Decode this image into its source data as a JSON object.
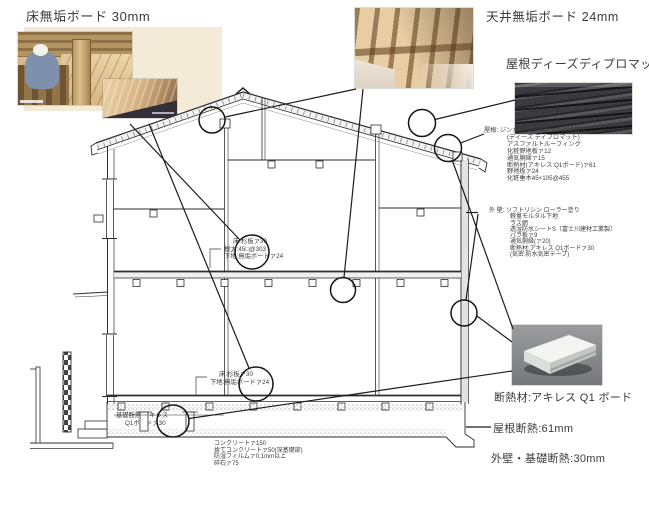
{
  "labels": {
    "floor_board": "床無垢ボード 30mm",
    "ceiling_board": "天井無垢ボード 24mm",
    "roof_diplomat": "屋根ディーズディプロマット",
    "insulation_board": "断熱材:アキレス Q1 ボード",
    "roof_insulation": "屋根断熱:61mm",
    "wall_foundation_insulation": "外壁・基礎断熱:30mm"
  },
  "roof_spec": {
    "heading": "屋根:",
    "lines": [
      "ジンカリウム鋼板ァ0.39横葺き",
      "(ディーズ ディプロマット)",
      "アスファルトルーフィング",
      "化粧野地板ァ12",
      "通気胴縁ァ15",
      "断熱材(アキレス:Q1ボード)ァ61",
      "野地板ァ24",
      "化粧垂木45×105@455"
    ]
  },
  "wall_spec": {
    "heading": "外 壁:",
    "lines": [
      "ソフトリシン ローラー塗り",
      "軽量モルタル下地",
      "ラス網",
      "透湿防水シートS〔富士川建材工業製〕",
      "バラ板ァ9",
      "通気胴縁(ァ20)",
      "断熱材:アキレス Q1ボードァ30",
      "(気密:防水気密テープ)"
    ]
  },
  "annotations": {
    "floor2_line1": "床:杉板ァ30",
    "floor2_line2": "根太:45□@303",
    "floor2_line3": "下地:無垢ボードァ24",
    "floor1_line1": "床:杉板ァ30",
    "floor1_line2": "下地:無垢ボードァ24",
    "foundation_ins_line1": "基礎断熱:アキレス",
    "foundation_ins_line2": "Q1ボードァ30",
    "concrete_line1": "コンクリートァ150",
    "concrete_line2": "捨てコンクリートァ50(深基礎部)",
    "concrete_line3": "防湿フィルムァ0.1mm以上",
    "concrete_line4": "砕石ァ75"
  },
  "colors": {
    "drawing_line": "#2d2d2d",
    "text": "#3a3a3a",
    "photo_mat": "#f4ead8",
    "roof_photo_dark": "#3f3f43",
    "insulation_photo_bg": "#8e8f91"
  }
}
